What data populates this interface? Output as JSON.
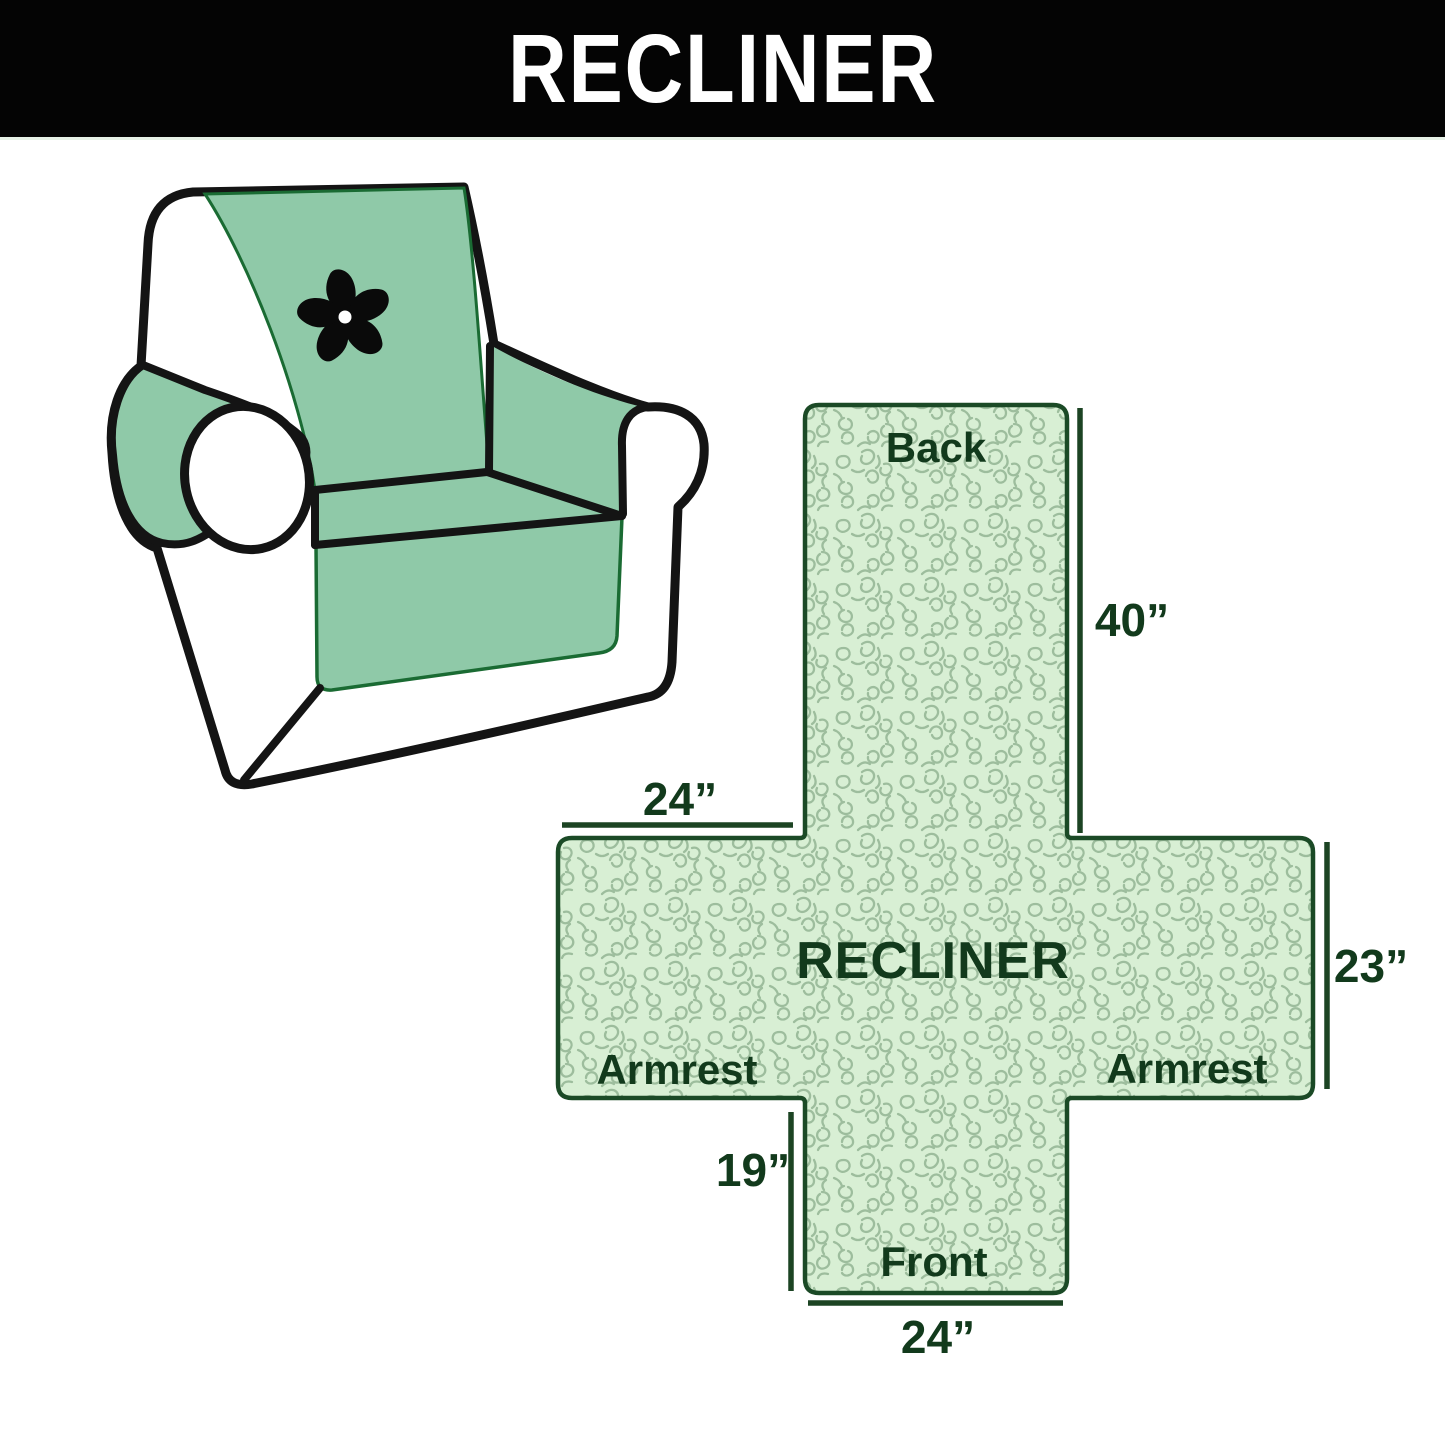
{
  "banner": {
    "title": "RECLINER",
    "bg_color": "#040404",
    "text_color": "#ffffff"
  },
  "chair_illustration": {
    "description": "armchair with quilted cover",
    "logo_icon": "pinwheel-icon",
    "cover_color": "#8fc9a8",
    "outline_color": "#141414",
    "trim_color": "#1a6b33"
  },
  "diagram": {
    "center_label": "RECLINER",
    "sections": {
      "back": "Back",
      "front": "Front",
      "armrest_left": "Armrest",
      "armrest_right": "Armrest"
    },
    "measurements": {
      "back_length": "40”",
      "top_width": "24”",
      "side_height": "23”",
      "front_drop": "19”",
      "bottom_width": "24”"
    },
    "dimensions_inches": {
      "back_length": 40,
      "top_width": 24,
      "side_height": 23,
      "front_drop": 19,
      "bottom_width": 24
    },
    "fill_color": "#d8efd4",
    "pattern_line_color": "#9dbd9d",
    "outline_color": "#1b4a26",
    "label_color": "#123a1c"
  }
}
